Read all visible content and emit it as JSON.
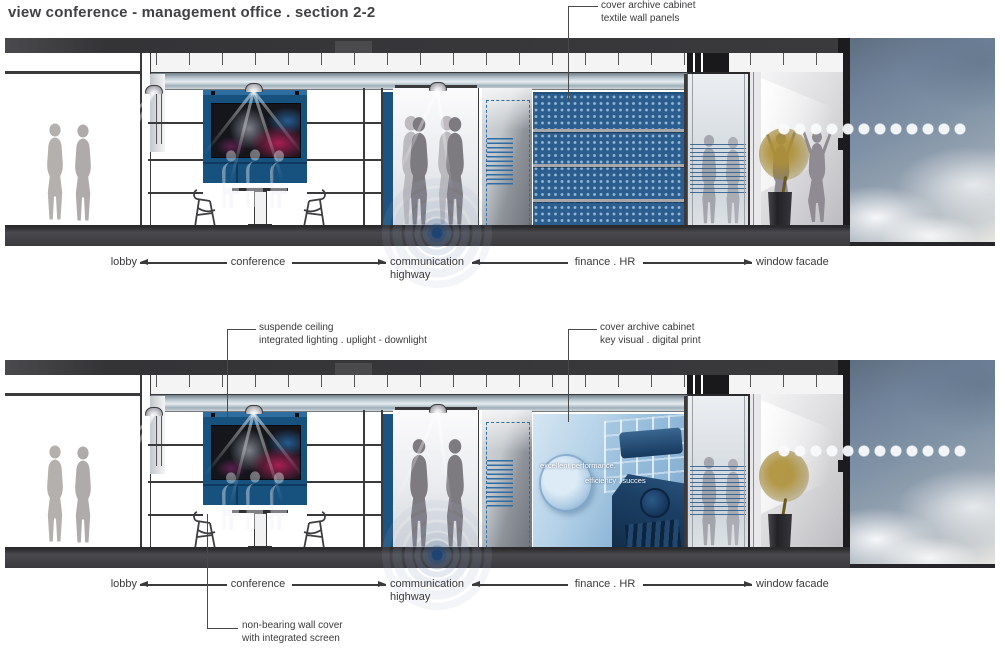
{
  "title": "view conference - management office . section 2-2",
  "annotations": {
    "textile": {
      "line1": "cover archive cabinet",
      "line2": "textile wall panels"
    },
    "ceiling": {
      "line1": "suspende ceiling",
      "line2": "integrated lighting . uplight - downlight"
    },
    "key_visual": {
      "line1": "cover archive cabinet",
      "line2": "key visual . digital print"
    },
    "wall_cover": {
      "line1": "non-bearing wall cover",
      "line2": "with integrated screen"
    }
  },
  "zones": {
    "lobby": "lobby",
    "conference": "conference",
    "communication1": "communication",
    "communication2": "highway",
    "finance": "finance . HR",
    "window": "window facade"
  },
  "print_text": {
    "line1": "excellent performance.",
    "line2": "efficiency . succes"
  },
  "colors": {
    "ink": "#3a3a3c",
    "panel_blue": "#2b5d8f",
    "media_wall_blue": "#17527f",
    "slab_gray": "#3a3a3d",
    "sky_slate": "#71839a"
  }
}
